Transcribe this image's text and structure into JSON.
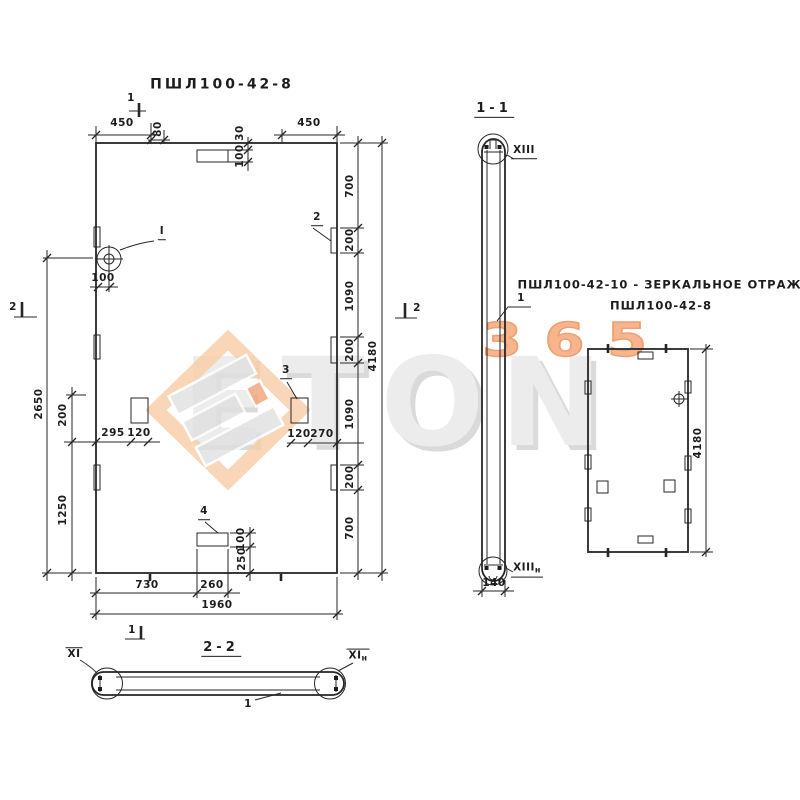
{
  "watermark": {
    "brand": "ETON",
    "digits": "365"
  },
  "main_view": {
    "title": "ПШЛ100-42-8",
    "marks": {
      "cut1_top": "1",
      "cut1_bottom": "1",
      "cut2_left": "2",
      "cut2_right": "2"
    },
    "items": {
      "loop": "I",
      "item2": "2",
      "item3": "3",
      "item4": "4"
    },
    "dims": {
      "top_450_left": "450",
      "top_80": "80",
      "top_450_right": "450",
      "top_30": "30",
      "top_100": "100",
      "right": [
        "700",
        "200",
        "1090",
        "200",
        "1090",
        "200",
        "700"
      ],
      "right_total": "4180",
      "left_total": "2650",
      "left_200": "200",
      "left_1250": "1250",
      "loop_100": "100",
      "mid_295": "295",
      "mid_120_left": "120",
      "mid_120_right": "120",
      "mid_270": "270",
      "item4_100": "100",
      "item4_250": "250",
      "bottom_730": "730",
      "bottom_260": "260",
      "bottom_total": "1960"
    }
  },
  "section_1_1": {
    "title": "1-1",
    "item": "1",
    "weld_top": "XIII",
    "weld_bottom": "XIII",
    "weld_bottom_sub": "н",
    "dim_140": "140"
  },
  "mirror_view": {
    "title_line1": "ПШЛ100-42-10 - ЗЕРКАЛЬНОЕ ОТРАЖЕНИЕ",
    "title_line2": "ПШЛ100-42-8",
    "dim_4180": "4180"
  },
  "section_2_2": {
    "title": "2-2",
    "item": "1",
    "weld_left": "XI",
    "weld_right": "XI",
    "weld_right_sub": "н"
  }
}
